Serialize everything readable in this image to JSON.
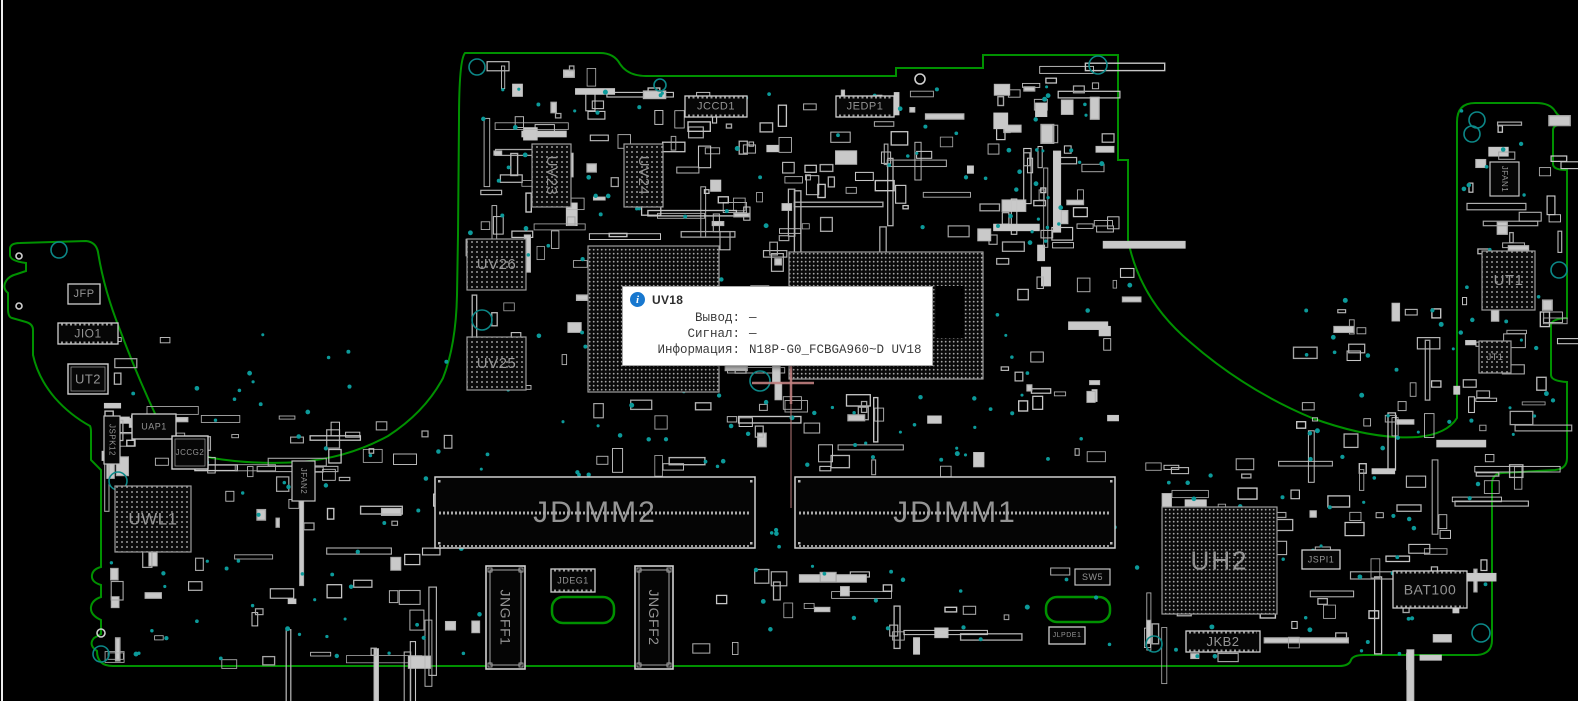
{
  "app": {
    "name": "boardview-canvas",
    "colors": {
      "board_outline": "#009100",
      "via_teal": "#0c9a9a",
      "hole_teal": "#0c8888",
      "part_stroke": "#b5b5b5",
      "silk_label": "#949494",
      "bga_dot": "#9a9a9a",
      "crosshair_pink": "#c08080",
      "tooltip_accent_blue": "#1878cf",
      "background": "#000000"
    }
  },
  "tooltip": {
    "icon": "info-icon",
    "title": "UV18",
    "rows": [
      {
        "label": "Вывод:",
        "value": "—"
      },
      {
        "label": "Сигнал:",
        "value": "—"
      },
      {
        "label": "Информация:",
        "value": "N18P-G0_FCBGA960~D UV18"
      }
    ]
  },
  "board": {
    "components": [
      {
        "label": "JFP",
        "kind": "conn",
        "x": 68,
        "y": 284,
        "w": 32,
        "h": 20,
        "fs": 11
      },
      {
        "label": "JIO1",
        "kind": "conn",
        "x": 58,
        "y": 323,
        "w": 60,
        "h": 21,
        "fs": 12,
        "ticks": true
      },
      {
        "label": "UT2",
        "kind": "chip",
        "x": 68,
        "y": 364,
        "w": 40,
        "h": 30,
        "fs": 13
      },
      {
        "label": "JSPK12",
        "kind": "box",
        "x": 104,
        "y": 416,
        "w": 16,
        "h": 48,
        "fs": 8,
        "vert": true
      },
      {
        "label": "UAP1",
        "kind": "conn",
        "x": 132,
        "y": 414,
        "w": 44,
        "h": 25,
        "fs": 9
      },
      {
        "label": "JCCG2",
        "kind": "chip",
        "x": 172,
        "y": 436,
        "w": 36,
        "h": 33,
        "fs": 8
      },
      {
        "label": "UWL1",
        "kind": "bga",
        "x": 115,
        "y": 486,
        "w": 76,
        "h": 66,
        "fs": 17
      },
      {
        "label": "JFAN2",
        "kind": "box",
        "x": 292,
        "y": 461,
        "w": 23,
        "h": 40,
        "fs": 8,
        "vert": true
      },
      {
        "label": "UV26",
        "kind": "bga",
        "x": 467,
        "y": 239,
        "w": 59,
        "h": 51,
        "fs": 15
      },
      {
        "label": "UV25",
        "kind": "bga",
        "x": 467,
        "y": 337,
        "w": 59,
        "h": 53,
        "fs": 15
      },
      {
        "label": "UV23",
        "kind": "bga",
        "x": 532,
        "y": 144,
        "w": 39,
        "h": 63,
        "fs": 15,
        "vert": true
      },
      {
        "label": "UV24",
        "kind": "bga",
        "x": 624,
        "y": 144,
        "w": 39,
        "h": 63,
        "fs": 15,
        "vert": true
      },
      {
        "label": "",
        "kind": "bga",
        "x": 588,
        "y": 246,
        "w": 131,
        "h": 146,
        "fs": 0,
        "name": "bga-uv18"
      },
      {
        "label": "",
        "kind": "bga",
        "x": 789,
        "y": 252,
        "w": 194,
        "h": 127,
        "fs": 0,
        "die": true,
        "name": "bga-cpu"
      },
      {
        "label": "JCCD1",
        "kind": "conn",
        "x": 685,
        "y": 96,
        "w": 62,
        "h": 21,
        "fs": 11,
        "ticks": true
      },
      {
        "label": "JEDP1",
        "kind": "conn",
        "x": 836,
        "y": 96,
        "w": 58,
        "h": 21,
        "fs": 11,
        "ticks": true
      },
      {
        "label": "JDIMM2",
        "kind": "dimm",
        "x": 435,
        "y": 477,
        "w": 320,
        "h": 71,
        "fs": 30
      },
      {
        "label": "JDIMM1",
        "kind": "dimm",
        "x": 795,
        "y": 477,
        "w": 320,
        "h": 71,
        "fs": 30
      },
      {
        "label": "JNGFF1",
        "kind": "ngff",
        "x": 486,
        "y": 566,
        "w": 39,
        "h": 103,
        "fs": 14,
        "vert": true
      },
      {
        "label": "JNGFF2",
        "kind": "ngff",
        "x": 635,
        "y": 566,
        "w": 38,
        "h": 103,
        "fs": 14,
        "vert": true
      },
      {
        "label": "JDEG1",
        "kind": "conn",
        "x": 551,
        "y": 569,
        "w": 44,
        "h": 23,
        "fs": 9,
        "ticks": true
      },
      {
        "label": "SW5",
        "kind": "box",
        "x": 1075,
        "y": 569,
        "w": 35,
        "h": 16,
        "fs": 9
      },
      {
        "label": "JLPDE1",
        "kind": "conn",
        "x": 1049,
        "y": 627,
        "w": 36,
        "h": 17,
        "fs": 7
      },
      {
        "label": "UH2",
        "kind": "bga",
        "x": 1162,
        "y": 507,
        "w": 115,
        "h": 107,
        "fs": 26
      },
      {
        "label": "JKB2",
        "kind": "conn",
        "x": 1186,
        "y": 631,
        "w": 74,
        "h": 21,
        "fs": 13,
        "ticks": true
      },
      {
        "label": "JSPI1",
        "kind": "conn",
        "x": 1302,
        "y": 550,
        "w": 38,
        "h": 19,
        "fs": 9
      },
      {
        "label": "BAT100",
        "kind": "conn",
        "x": 1393,
        "y": 571,
        "w": 74,
        "h": 37,
        "fs": 14,
        "ticks": true
      },
      {
        "label": "JT1",
        "kind": "bga",
        "x": 1479,
        "y": 341,
        "w": 32,
        "h": 32,
        "fs": 9
      },
      {
        "label": "JFAN1",
        "kind": "box",
        "x": 1490,
        "y": 162,
        "w": 29,
        "h": 34,
        "fs": 8,
        "vert": true
      },
      {
        "label": "UT1",
        "kind": "bga",
        "x": 1482,
        "y": 251,
        "w": 53,
        "h": 59,
        "fs": 15
      }
    ]
  }
}
